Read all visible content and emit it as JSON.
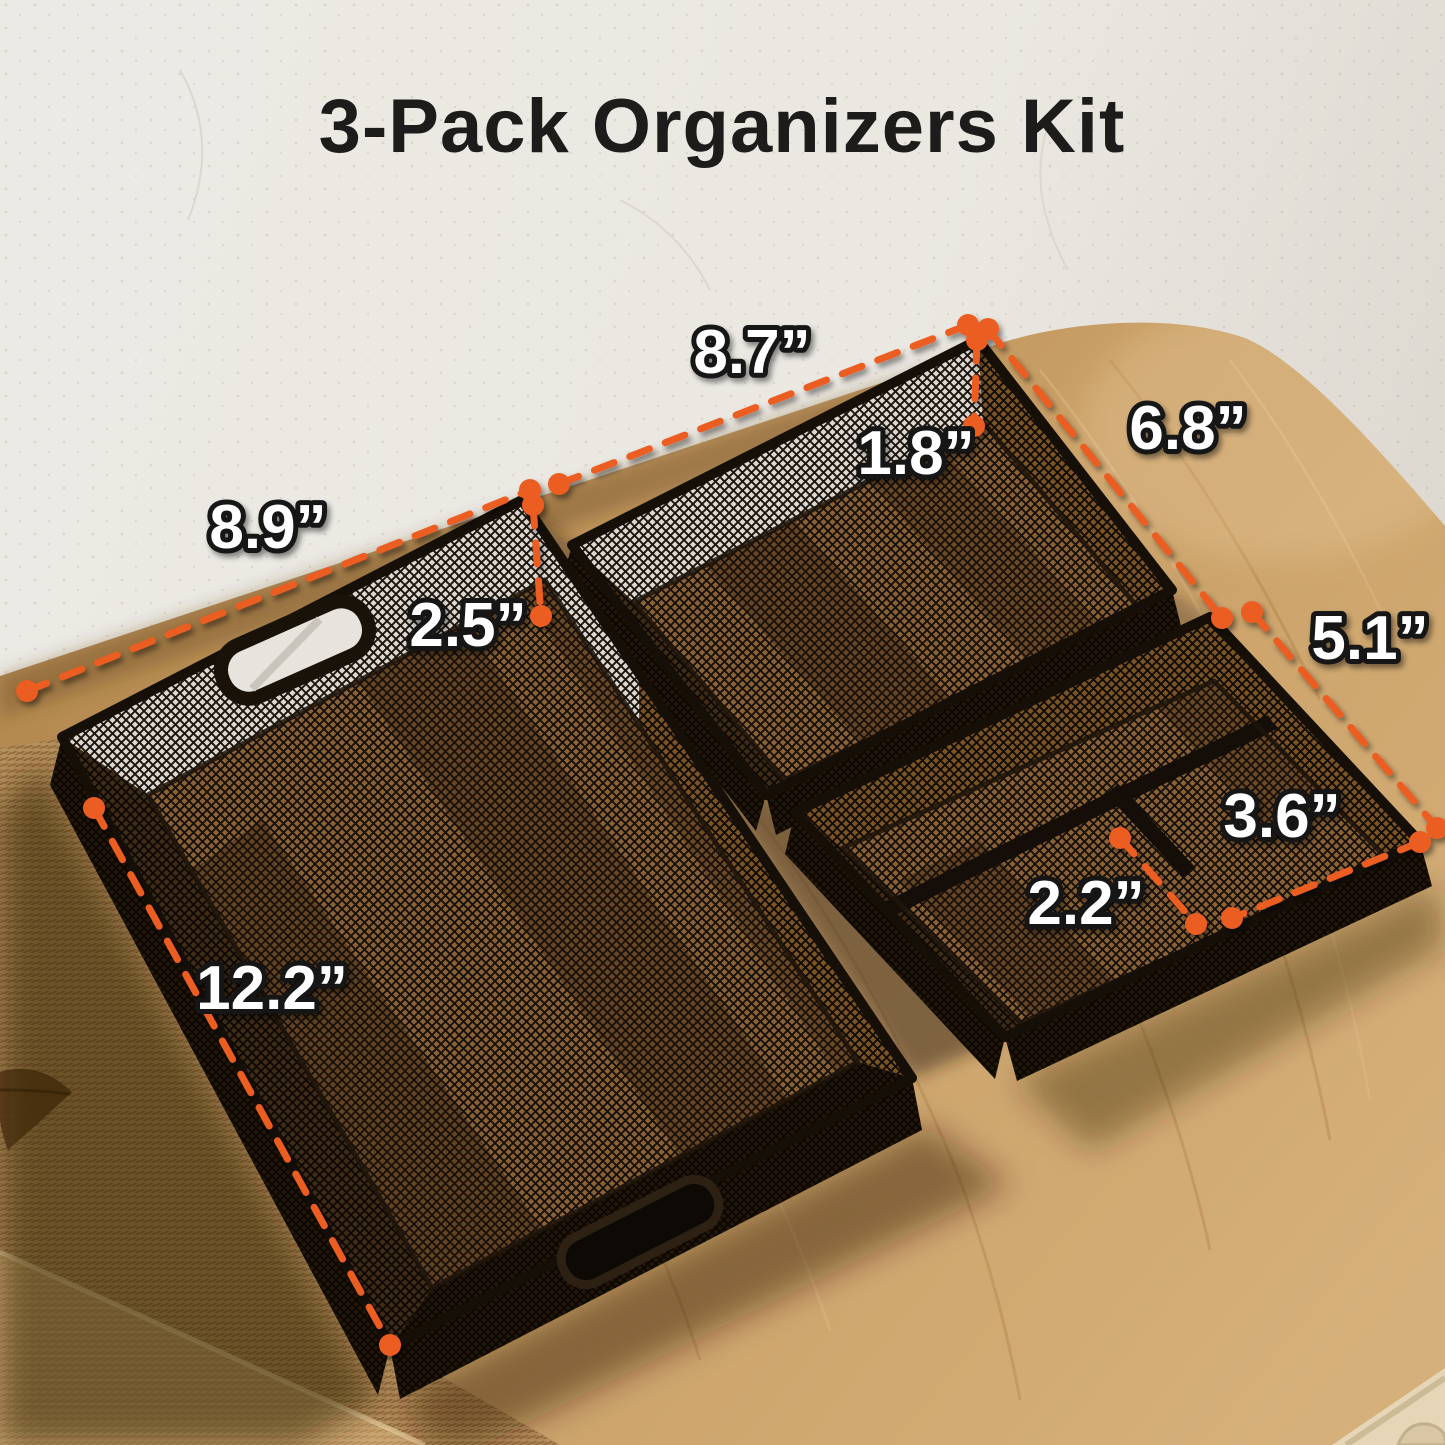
{
  "title": "3-Pack Organizers Kit",
  "annotations": {
    "large_tray": {
      "width": "8.9”",
      "height": "2.5”",
      "length": "12.2”"
    },
    "medium_tray": {
      "length": "8.7”",
      "height": "1.8”",
      "width": "6.8”"
    },
    "small_organizer": {
      "length": "5.1”",
      "width": "3.6”",
      "height": "2.2”"
    }
  },
  "colors": {
    "accent_orange": "#EC5D24",
    "label_fill": "#FFFFFF",
    "label_outline": "#141414",
    "title_text": "#1D1C1A",
    "wood": "#C89F66",
    "wall": "#EBE8E2",
    "mesh_black": "#17100A"
  },
  "scene": {
    "products": [
      "large mesh tray with handles",
      "medium mesh tray",
      "small mesh drawer organizer with compartments"
    ],
    "surface": "wooden table",
    "background": "white plaster wall"
  }
}
